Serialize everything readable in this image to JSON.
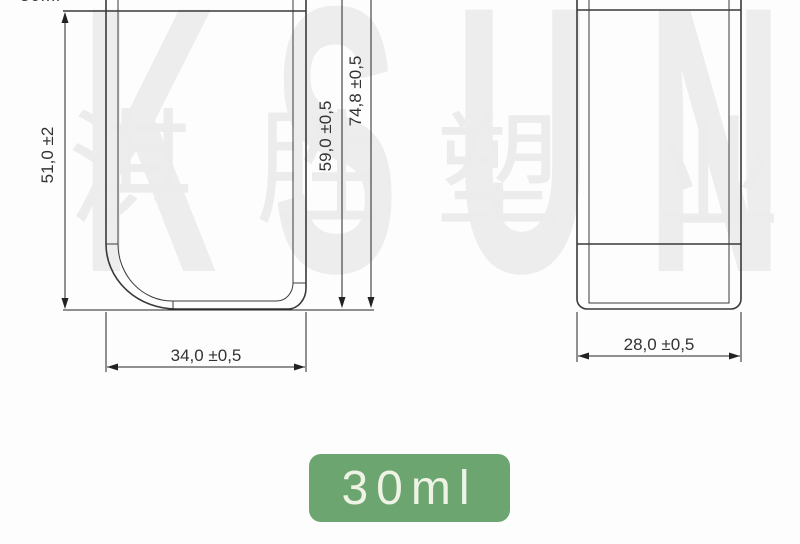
{
  "watermark": {
    "latin": "KSUN",
    "cjk": [
      "淇",
      "胜",
      "塑",
      "业"
    ],
    "color": "#ededed"
  },
  "top_clipped_label": "30ml",
  "drawing": {
    "line_color": "#3a3a3a",
    "front_view": {
      "body_height_label": "51,0 ±2",
      "shoulder_height_label": "59,0 ±0,5",
      "total_height_label": "74,8 ±0,5",
      "width_label": "34,0 ±0,5"
    },
    "side_view": {
      "width_label": "28,0 ±0,5"
    }
  },
  "badge": {
    "label": "30ml",
    "bg": "#6da570",
    "text_color": "#eef3e5"
  }
}
